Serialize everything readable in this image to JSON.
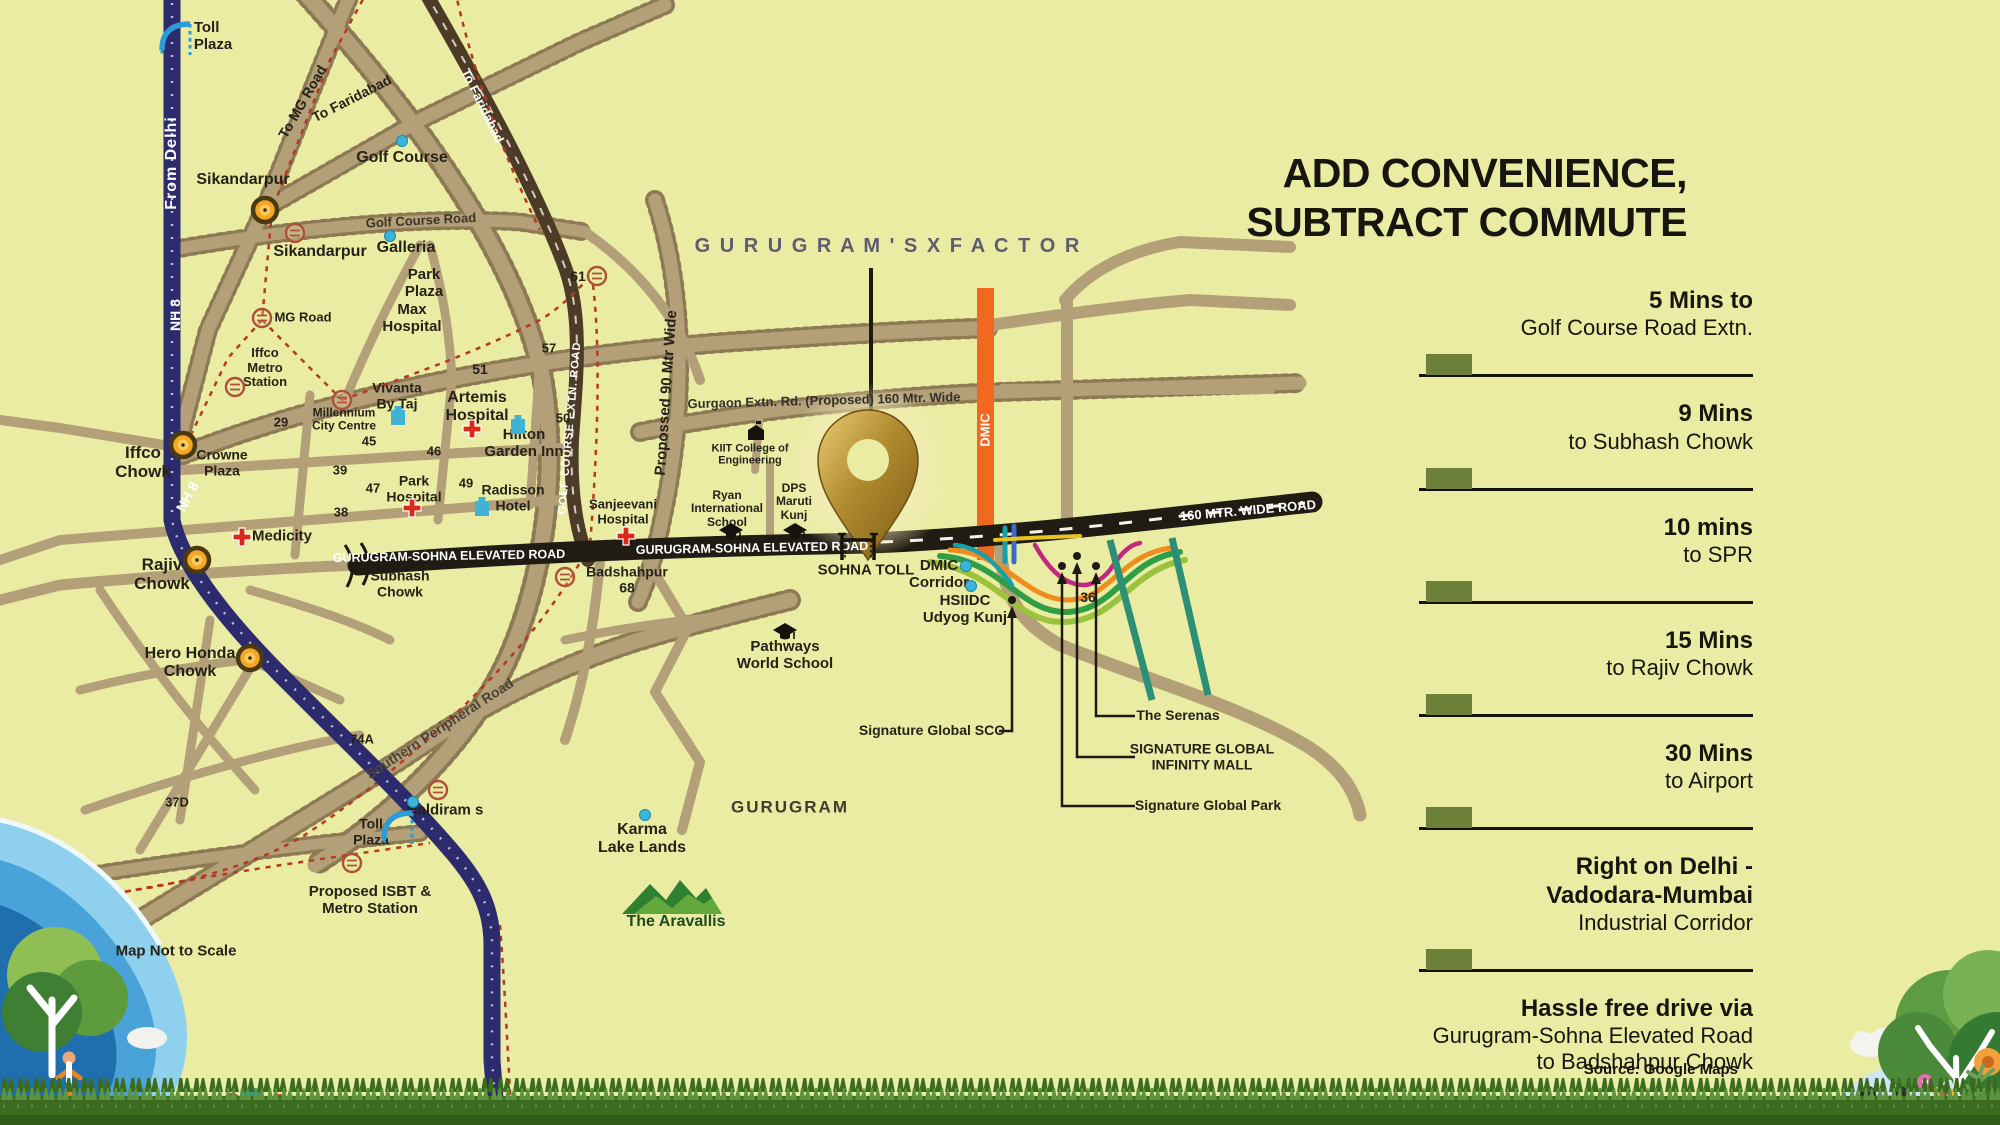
{
  "palette": {
    "bg": "#e9eca2",
    "ink": "#262219",
    "panel-ink": "#17150f",
    "olive": "#6d8039",
    "road": "#b3a079",
    "road-edge": "#8d7a55",
    "road-dark": "#4c3b27",
    "nh8": "#2b2b6e",
    "black-road": "#201b13",
    "dmic": "#f2681f",
    "slate": "#5d5d70",
    "teal": "#2e8f77",
    "red-dash": "#b5391f",
    "cyan": "#38b6da",
    "chowk": "#f5a623",
    "gold-pin": "#b08a2e"
  },
  "panel": {
    "title_line1": "ADD CONVENIENCE,",
    "title_line2": "SUBTRACT COMMUTE",
    "items": [
      {
        "lines": [
          {
            "t": "5 Mins to",
            "b": true
          },
          {
            "t": "Golf Course Road Extn.",
            "b": false
          }
        ],
        "bar": true
      },
      {
        "lines": [
          {
            "t": "9 Mins",
            "b": true
          },
          {
            "t": "to Subhash Chowk",
            "b": false
          }
        ],
        "bar": true
      },
      {
        "lines": [
          {
            "t": "10 mins",
            "b": true
          },
          {
            "t": "to SPR",
            "b": false
          }
        ],
        "bar": true
      },
      {
        "lines": [
          {
            "t": "15 Mins",
            "b": true
          },
          {
            "t": "to Rajiv Chowk",
            "b": false
          }
        ],
        "bar": true
      },
      {
        "lines": [
          {
            "t": "30 Mins",
            "b": true
          },
          {
            "t": "to Airport",
            "b": false
          }
        ],
        "bar": true
      },
      {
        "lines": [
          {
            "t": "Right on Delhi -",
            "b": true
          },
          {
            "t": "Vadodara-Mumbai",
            "b": true
          },
          {
            "t": "Industrial Corridor",
            "b": false
          }
        ],
        "bar": true
      },
      {
        "lines": [
          {
            "t": "Hassle free drive via",
            "b": true
          },
          {
            "t": "Gurugram-Sohna Elevated Road",
            "b": false
          },
          {
            "t": "to Badshahpur Chowk",
            "b": false
          }
        ],
        "bar": false
      }
    ],
    "source": "Source: Google Maps"
  },
  "map": {
    "labels": [
      {
        "n": "xfactor-title",
        "t": "G U R U G R A M ' S   X   F A C T O R",
        "x": 888,
        "y": 246,
        "fs": 20,
        "c": "#5d5d70",
        "ls": 2
      },
      {
        "n": "toll-plaza-top",
        "t": "Toll\nPlaza",
        "x": 213,
        "y": 37,
        "fs": 15,
        "align": "left"
      },
      {
        "n": "from-delhi",
        "t": "From Delhi",
        "x": 172,
        "y": 163,
        "fs": 16,
        "c": "#ffffff",
        "r": -90,
        "ls": 1
      },
      {
        "n": "nh8-a",
        "t": "NH 8",
        "x": 176,
        "y": 315,
        "fs": 14,
        "c": "#ffffff",
        "r": -90
      },
      {
        "n": "nh8-b",
        "t": "NH 8",
        "x": 188,
        "y": 497,
        "fs": 14,
        "c": "#ffffff",
        "r": -62
      },
      {
        "n": "sikandarpur-1",
        "t": "Sikandarpur",
        "x": 243,
        "y": 180,
        "fs": 16
      },
      {
        "n": "sikandarpur-2",
        "t": "Sikandarpur",
        "x": 320,
        "y": 252,
        "fs": 16
      },
      {
        "n": "to-mg-road",
        "t": "To MG Road",
        "x": 303,
        "y": 102,
        "fs": 14,
        "r": -60
      },
      {
        "n": "to-faridabad-tan",
        "t": "To Faridabad",
        "x": 352,
        "y": 99,
        "fs": 14,
        "r": -27
      },
      {
        "n": "to-faridabad-dark",
        "t": "To Faridabad",
        "x": 482,
        "y": 106,
        "fs": 13,
        "c": "#ffffff",
        "r": 64
      },
      {
        "n": "golf-course",
        "t": "Golf Course",
        "x": 402,
        "y": 158,
        "fs": 16
      },
      {
        "n": "golf-course-road",
        "t": "Golf Course Road",
        "x": 421,
        "y": 221,
        "fs": 13,
        "c": "#3a3328",
        "r": -3
      },
      {
        "n": "galleria",
        "t": "Galleria",
        "x": 406,
        "y": 248,
        "fs": 16
      },
      {
        "n": "park-plaza",
        "t": "Park\nPlaza",
        "x": 424,
        "y": 284,
        "fs": 15
      },
      {
        "n": "max-hospital",
        "t": "Max\nHospital",
        "x": 412,
        "y": 319,
        "fs": 15
      },
      {
        "n": "mg-road",
        "t": "MG Road",
        "x": 303,
        "y": 318,
        "fs": 13
      },
      {
        "n": "iffco-metro-station",
        "t": "Iffco\nMetro\nStation",
        "x": 265,
        "y": 368,
        "fs": 13
      },
      {
        "n": "millennium-city-centre",
        "t": "Millennium\nCity Centre",
        "x": 344,
        "y": 420,
        "fs": 12
      },
      {
        "n": "vivanta-by-taj",
        "t": "Vivanta\nBy Taj",
        "x": 397,
        "y": 396,
        "fs": 14
      },
      {
        "n": "sector-51",
        "t": "51",
        "x": 480,
        "y": 370,
        "fs": 14
      },
      {
        "n": "artemis-hospital",
        "t": "Artemis\nHospital",
        "x": 477,
        "y": 407,
        "fs": 16
      },
      {
        "n": "hilton-garden-inn",
        "t": "Hilton\nGarden Inn",
        "x": 524,
        "y": 444,
        "fs": 15
      },
      {
        "n": "sector-29",
        "t": "29",
        "x": 281,
        "y": 423,
        "fs": 13
      },
      {
        "n": "sector-45",
        "t": "45",
        "x": 369,
        "y": 442,
        "fs": 13
      },
      {
        "n": "sector-46",
        "t": "46",
        "x": 434,
        "y": 452,
        "fs": 13
      },
      {
        "n": "sector-39",
        "t": "39",
        "x": 340,
        "y": 471,
        "fs": 13
      },
      {
        "n": "sector-47",
        "t": "47",
        "x": 373,
        "y": 489,
        "fs": 13
      },
      {
        "n": "park-hospital",
        "t": "Park\nHospital",
        "x": 414,
        "y": 489,
        "fs": 14
      },
      {
        "n": "sector-49",
        "t": "49",
        "x": 466,
        "y": 484,
        "fs": 13
      },
      {
        "n": "radisson-hotel",
        "t": "Radisson\nHotel",
        "x": 513,
        "y": 498,
        "fs": 14
      },
      {
        "n": "sector-38",
        "t": "38",
        "x": 341,
        "y": 513,
        "fs": 13
      },
      {
        "n": "iffco-chowk",
        "t": "Iffco\nChowk",
        "x": 143,
        "y": 462,
        "fs": 17
      },
      {
        "n": "crowne-plaza",
        "t": "Crowne\nPlaza",
        "x": 222,
        "y": 463,
        "fs": 14
      },
      {
        "n": "medicity",
        "t": "Medicity",
        "x": 282,
        "y": 537,
        "fs": 15
      },
      {
        "n": "rajiv-chowk",
        "t": "Rajiv\nChowk",
        "x": 162,
        "y": 574,
        "fs": 17
      },
      {
        "n": "gurugram-sohna-elevated-road-1",
        "t": "GURUGRAM-SOHNA ELEVATED ROAD",
        "x": 449,
        "y": 556,
        "fs": 12.5,
        "c": "#ffffff",
        "r": -1
      },
      {
        "n": "gurugram-sohna-elevated-road-2",
        "t": "GURUGRAM-SOHNA ELEVATED ROAD",
        "x": 752,
        "y": 548,
        "fs": 12.5,
        "c": "#ffffff",
        "r": -1
      },
      {
        "n": "subhash-chowk",
        "t": "Subhash\nChowk",
        "x": 400,
        "y": 584,
        "fs": 14
      },
      {
        "n": "badshahpur-68",
        "t": "Badshahpur\n68",
        "x": 627,
        "y": 580,
        "fs": 14
      },
      {
        "n": "sector-61",
        "t": "61",
        "x": 578,
        "y": 277,
        "fs": 14
      },
      {
        "n": "golf-course-extn-road",
        "t": "GOLF COURSE EXTN. ROAD",
        "x": 570,
        "y": 428,
        "fs": 11,
        "c": "#ffffff",
        "r": -85,
        "ls": 1
      },
      {
        "n": "proposed-90-mtr-wide",
        "t": "Propossed 90 Mtr Wide",
        "x": 667,
        "y": 393,
        "fs": 15,
        "r": -86
      },
      {
        "n": "gurgaon-extn-rd",
        "t": "Gurgaon Extn. Rd. (Proposed) 160 Mtr. Wide",
        "x": 824,
        "y": 401,
        "fs": 13,
        "c": "#33302a",
        "r": -1.5
      },
      {
        "n": "kiit-college",
        "t": "KIIT College of\nEngineering",
        "x": 750,
        "y": 455,
        "fs": 11
      },
      {
        "n": "ryan-international-school",
        "t": "Ryan\nInternational\nSchool",
        "x": 727,
        "y": 509,
        "fs": 12
      },
      {
        "n": "dps-maruti-kunj",
        "t": "DPS\nMaruti\nKunj",
        "x": 794,
        "y": 502,
        "fs": 12
      },
      {
        "n": "sanjeevani-hospital",
        "t": "Sanjeevani\nHospital",
        "x": 623,
        "y": 512,
        "fs": 13
      },
      {
        "n": "sohna-toll",
        "t": "SOHNA TOLL",
        "x": 866,
        "y": 571,
        "fs": 15
      },
      {
        "n": "dmic-corridor",
        "t": "DMIC\nCorridor",
        "x": 939,
        "y": 575,
        "fs": 15
      },
      {
        "n": "hsiidc-udyog-kunj",
        "t": "HSIIDC\nUdyog Kunj",
        "x": 965,
        "y": 610,
        "fs": 15
      },
      {
        "n": "sector-36",
        "t": "36",
        "x": 1088,
        "y": 598,
        "fs": 14
      },
      {
        "n": "dmic-band-label",
        "t": "DMIC",
        "x": 986,
        "y": 430,
        "fs": 13,
        "c": "#ffffff",
        "r": -90
      },
      {
        "n": "road-160-mtr",
        "t": "160 MTR. WIDE ROAD",
        "x": 1248,
        "y": 511,
        "fs": 13,
        "c": "#ffffff",
        "r": -5
      },
      {
        "n": "the-serenas",
        "t": "The Serenas",
        "x": 1178,
        "y": 716,
        "fs": 14
      },
      {
        "n": "signature-global-infinity-mall",
        "t": "SIGNATURE GLOBAL\nINFINITY MALL",
        "x": 1202,
        "y": 757,
        "fs": 14
      },
      {
        "n": "signature-global-park",
        "t": "Signature Global Park",
        "x": 1208,
        "y": 806,
        "fs": 14
      },
      {
        "n": "signature-global-sco",
        "t": "Signature Global SCO",
        "x": 932,
        "y": 731,
        "fs": 14
      },
      {
        "n": "pathways-world-school",
        "t": "Pathways\nWorld School",
        "x": 785,
        "y": 656,
        "fs": 15
      },
      {
        "n": "gurugram-city",
        "t": "GURUGRAM",
        "x": 790,
        "y": 807,
        "fs": 17,
        "c": "#3f3b2f",
        "ls": 2
      },
      {
        "n": "karma-lake-lands",
        "t": "Karma\nLake Lands",
        "x": 642,
        "y": 839,
        "fs": 16
      },
      {
        "n": "the-aravallis",
        "t": "The Aravallis",
        "x": 676,
        "y": 922,
        "fs": 16,
        "c": "#1c4a21"
      },
      {
        "n": "haldirams",
        "t": "Haldiram s",
        "x": 445,
        "y": 811,
        "fs": 15
      },
      {
        "n": "toll-plaza-bottom",
        "t": "Toll\nPlaza",
        "x": 371,
        "y": 832,
        "fs": 14
      },
      {
        "n": "proposed-isbt",
        "t": "Proposed ISBT &\nMetro Station",
        "x": 370,
        "y": 901,
        "fs": 15
      },
      {
        "n": "sector-74a",
        "t": "74A",
        "x": 362,
        "y": 740,
        "fs": 13
      },
      {
        "n": "sector-37d",
        "t": "37D",
        "x": 177,
        "y": 803,
        "fs": 13
      },
      {
        "n": "hero-honda-chowk",
        "t": "Hero Honda\nChowk",
        "x": 190,
        "y": 663,
        "fs": 16
      },
      {
        "n": "southern-peripheral-road",
        "t": "Southern Peripheral Road",
        "x": 440,
        "y": 729,
        "fs": 14,
        "c": "#4a4438",
        "r": -33
      },
      {
        "n": "sector-57",
        "t": "57",
        "x": 549,
        "y": 349,
        "fs": 13
      },
      {
        "n": "sector-50",
        "t": "50",
        "x": 563,
        "y": 419,
        "fs": 13
      },
      {
        "n": "map-disclaimer",
        "t": "Map Not to Scale",
        "x": 176,
        "y": 952,
        "fs": 15
      }
    ],
    "icons": [
      {
        "type": "chowk",
        "n": "sikandarpur-chowk-dot",
        "x": 265,
        "y": 210
      },
      {
        "type": "chowk",
        "n": "iffco-chowk-dot",
        "x": 183,
        "y": 445
      },
      {
        "type": "chowk",
        "n": "rajiv-chowk-dot",
        "x": 197,
        "y": 560
      },
      {
        "type": "chowk",
        "n": "hero-honda-chowk-dot",
        "x": 250,
        "y": 658
      },
      {
        "type": "metro",
        "n": "sikandarpur-metro-icon",
        "x": 295,
        "y": 233
      },
      {
        "type": "metro",
        "n": "mg-road-metro-icon",
        "x": 262,
        "y": 318
      },
      {
        "type": "metro",
        "n": "iffco-metro-icon",
        "x": 235,
        "y": 387
      },
      {
        "type": "metro",
        "n": "millennium-metro-icon",
        "x": 342,
        "y": 400
      },
      {
        "type": "metro",
        "n": "sector61-metro-icon",
        "x": 597,
        "y": 276
      },
      {
        "type": "metro",
        "n": "badshahpur-metro-icon",
        "x": 565,
        "y": 577
      },
      {
        "type": "metro",
        "n": "haldiram-metro-icon",
        "x": 438,
        "y": 790
      },
      {
        "type": "metro",
        "n": "isbt-metro-icon",
        "x": 352,
        "y": 863
      },
      {
        "type": "dot",
        "n": "golf-course-dot",
        "x": 402,
        "y": 141
      },
      {
        "type": "dot",
        "n": "galleria-dot",
        "x": 390,
        "y": 236
      },
      {
        "type": "dot",
        "n": "haldiram-dot",
        "x": 413,
        "y": 802
      },
      {
        "type": "dot",
        "n": "karma-dot",
        "x": 645,
        "y": 815
      },
      {
        "type": "dot",
        "n": "dmic-dot-1",
        "x": 966,
        "y": 566
      },
      {
        "type": "dot",
        "n": "dmic-dot-2",
        "x": 971,
        "y": 586
      },
      {
        "type": "hotel",
        "n": "vivanta-hotel-icon",
        "x": 398,
        "y": 416
      },
      {
        "type": "hotel",
        "n": "hilton-hotel-icon",
        "x": 518,
        "y": 425
      },
      {
        "type": "hotel",
        "n": "radisson-hotel-icon",
        "x": 482,
        "y": 507
      },
      {
        "type": "cross",
        "n": "artemis-hospital-icon",
        "x": 472,
        "y": 429
      },
      {
        "type": "cross",
        "n": "park-hospital-icon",
        "x": 412,
        "y": 508
      },
      {
        "type": "cross",
        "n": "medicity-hospital-icon",
        "x": 242,
        "y": 537
      },
      {
        "type": "cross",
        "n": "sanjeevani-hospital-icon",
        "x": 626,
        "y": 536
      },
      {
        "type": "cap",
        "n": "pathways-school-icon",
        "x": 785,
        "y": 632
      },
      {
        "type": "cap",
        "n": "ryan-school-icon",
        "x": 731,
        "y": 532
      },
      {
        "type": "cap",
        "n": "dps-school-icon",
        "x": 795,
        "y": 532
      },
      {
        "type": "college",
        "n": "kiit-college-icon",
        "x": 756,
        "y": 432
      },
      {
        "type": "tollgate",
        "n": "sohna-toll-gate-icon",
        "x": 858,
        "y": 547
      },
      {
        "type": "tollblue",
        "n": "toll-plaza-top-icon",
        "x": 176,
        "y": 38
      },
      {
        "type": "tollblue",
        "n": "toll-plaza-bottom-icon",
        "x": 398,
        "y": 827
      },
      {
        "type": "hills",
        "n": "aravallis-hills-icon",
        "x": 672,
        "y": 896
      }
    ]
  }
}
